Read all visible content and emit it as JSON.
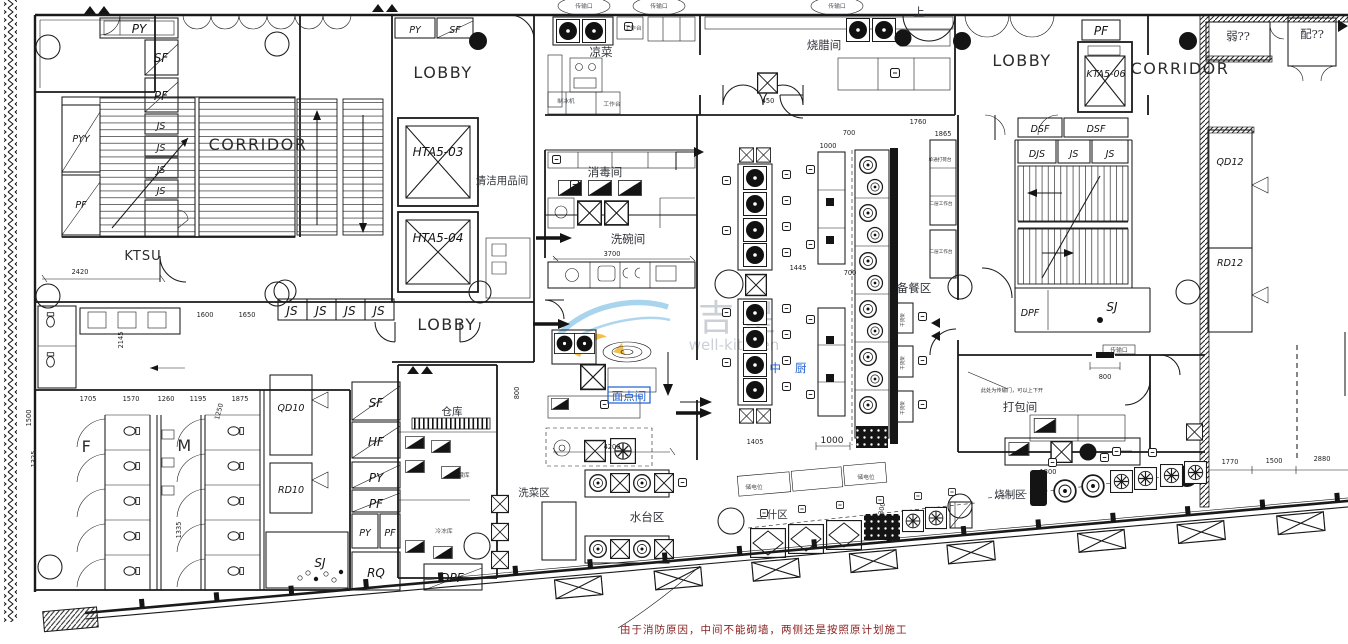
{
  "labels": {
    "lobby": "LOBBY",
    "corridor": "CORRIDOR",
    "ktsu": "KTSU",
    "hta5_03": "HTA5-03",
    "hta5_04": "HTA5-04",
    "kta5_06": "KTA5-06",
    "py": "PY",
    "pyy": "PYY",
    "sf": "SF",
    "pf": "PF",
    "js": "JS",
    "hf": "HF",
    "rq": "RQ",
    "dsf": "DSF",
    "djs": "DJS",
    "dpf": "DPF",
    "sj": "SJ",
    "qd10": "QD10",
    "rd10": "RD10",
    "qd12": "QD12",
    "rd12": "RD12",
    "f": "F",
    "m": "M",
    "up": "上",
    "weak_room": "弱??",
    "power_room": "配??"
  },
  "rooms": {
    "cleaning": "清洁用品间",
    "cold_dish": "凉菜",
    "roast": "烧腊间",
    "disinfect": "消毒间",
    "dishwash": "洗碗间",
    "pastry": "面点间",
    "main_kitchen": "中厨",
    "prep": "备餐区",
    "packing": "打包间",
    "roast_zone": "烧制区",
    "soup_zone": "上什区",
    "water_zone": "水台区",
    "veg_wash": "洗菜区",
    "storage": "仓库",
    "cold_store": "冷藏库",
    "freezer": "冷冻库"
  },
  "equipment": {
    "worktable": "工作台",
    "ice_maker": "制冰机",
    "power_point": "储电位",
    "pass_window": "传输口",
    "single_pass_counter": "单通打荷台",
    "double_worktable": "二层工作台",
    "dry_rack": "干货架"
  },
  "dims": {
    "d2420": "2420",
    "d1600": "1600",
    "d1650": "1650",
    "d2145": "2145",
    "d1500": "1500",
    "d1325": "1325",
    "d1705": "1705",
    "d1570": "1570",
    "d1260": "1260",
    "d1195": "1195",
    "d1250": "1250",
    "d1875": "1875",
    "d1335": "1335",
    "d800": "800",
    "d4200": "4200",
    "d3700": "3700",
    "d1445": "1445",
    "d700": "700",
    "d1000": "1000",
    "d450": "450",
    "d1405": "1405",
    "d300": "300",
    "d1800": "1800",
    "d1770": "1770",
    "d2880": "2880",
    "d1760": "1760",
    "d1865": "1865",
    "d5760": "5760"
  },
  "notes": {
    "fire_note": "由于消防原因，中间不能砌墙，两侧还是按照原计划施工",
    "transfer_note": "此处为传输门，可以上下开"
  },
  "watermark": {
    "brand": "吉星",
    "name": "well-kitchen"
  },
  "colors": {
    "line": "#1a1a1a",
    "highlight": "#1f5fd0",
    "note": "#8a1f1f",
    "wm_blue": "#8cc6e8",
    "wm_yellow": "#f0b429",
    "wm_gray": "#c6ccd3"
  }
}
